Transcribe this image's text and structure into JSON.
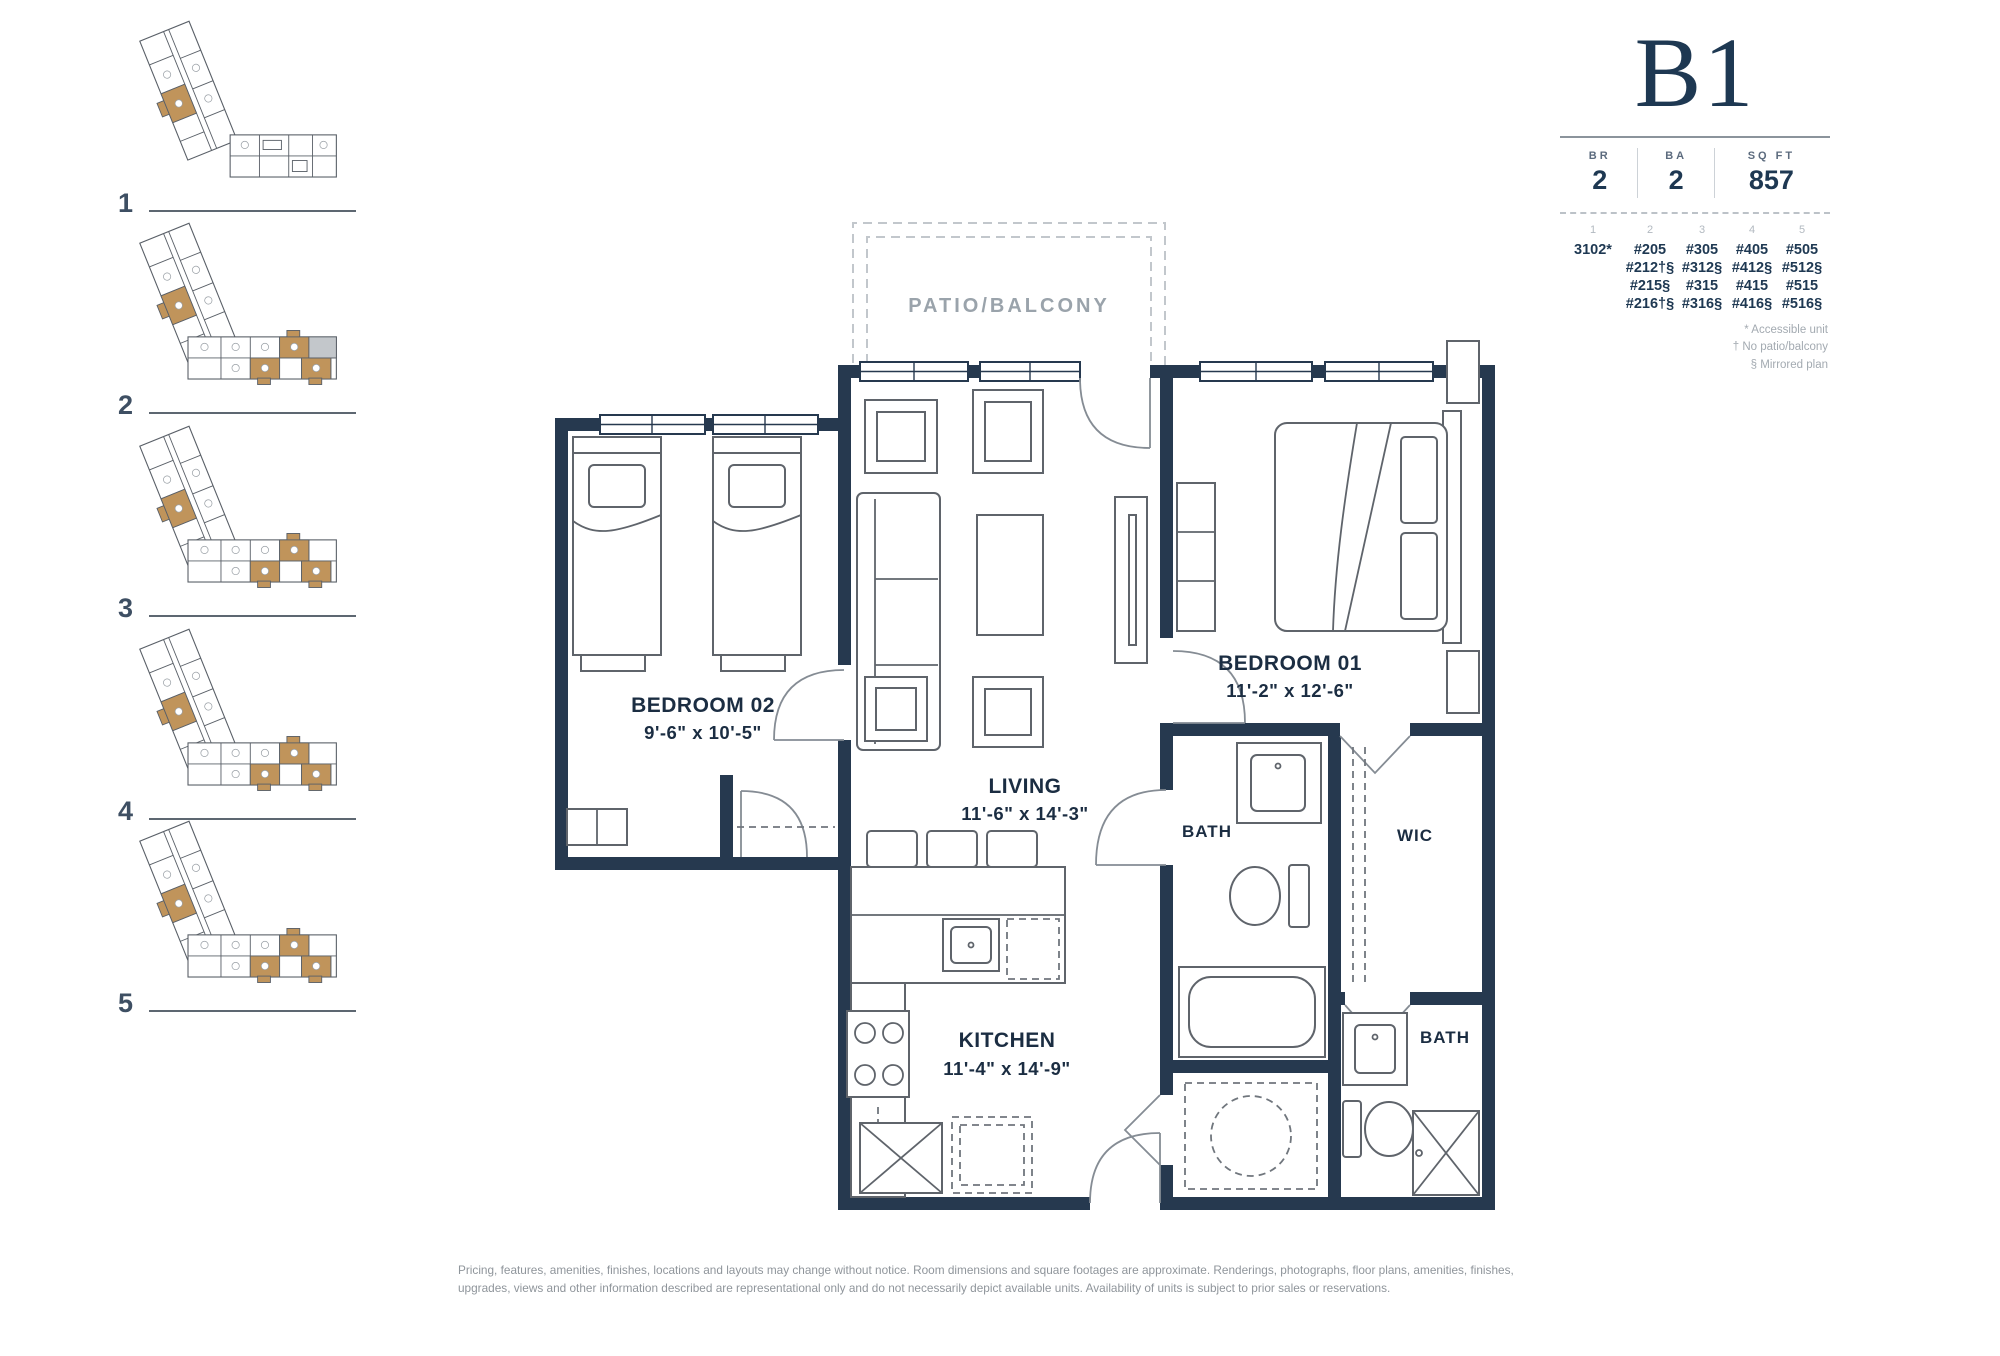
{
  "unit": {
    "name": "B1",
    "stats": [
      {
        "label": "BR",
        "value": "2"
      },
      {
        "label": "BA",
        "value": "2"
      },
      {
        "label": "SQ FT",
        "value": "857"
      }
    ],
    "availability": {
      "floors": [
        "1",
        "2",
        "3",
        "4",
        "5"
      ],
      "columns": [
        [
          "3102*"
        ],
        [
          "#205",
          "#212†§",
          "#215§",
          "#216†§"
        ],
        [
          "#305",
          "#312§",
          "#315",
          "#316§"
        ],
        [
          "#405",
          "#412§",
          "#415",
          "#416§"
        ],
        [
          "#505",
          "#512§",
          "#515",
          "#516§"
        ]
      ],
      "footnotes": [
        "* Accessible unit",
        "† No patio/balcony",
        "§ Mirrored plan"
      ]
    }
  },
  "key_plans": {
    "floors": [
      "1",
      "2",
      "3",
      "4",
      "5"
    ]
  },
  "floor_plan": {
    "patio_label": "PATIO/BALCONY",
    "rooms": {
      "bedroom02": {
        "name": "BEDROOM 02",
        "dims": "9'-6\" x 10'-5\""
      },
      "living": {
        "name": "LIVING",
        "dims": "11'-6\" x 14'-3\""
      },
      "bedroom01": {
        "name": "BEDROOM 01",
        "dims": "11'-2\" x 12'-6\""
      },
      "kitchen": {
        "name": "KITCHEN",
        "dims": "11'-4\" x 14'-9\""
      },
      "bath_main": {
        "name": "BATH"
      },
      "wic": {
        "name": "WIC"
      },
      "bath_second": {
        "name": "BATH"
      }
    }
  },
  "disclaimer": "Pricing, features, amenities, finishes, locations and layouts may change without notice. Room dimensions and square footages are approximate. Renderings, photographs, floor plans, amenities, finishes, upgrades, views and other information described are representational only and do not necessarily depict available units. Availability of units is subject to prior sales or reservations.",
  "colors": {
    "wall_navy": "#26394f",
    "highlight_gold": "#c0945b",
    "label_gray": "#9aa3ab",
    "amenity_gray": "#c3c7cb"
  }
}
